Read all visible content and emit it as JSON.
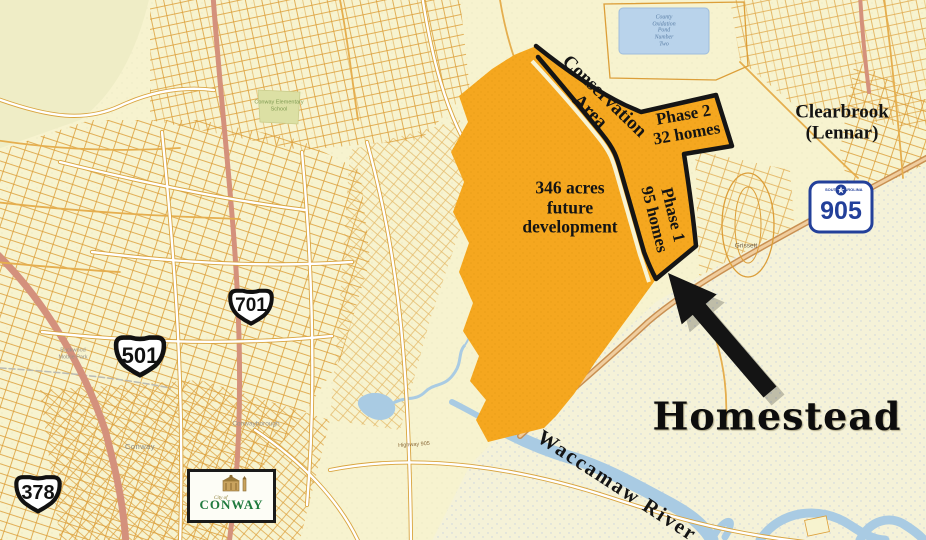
{
  "title": "Homestead development location map",
  "labels": {
    "conservation": [
      "Conservation",
      "Area"
    ],
    "phase2": [
      "Phase 2",
      "32 homes"
    ],
    "phase1": [
      "Phase 1",
      "95 homes"
    ],
    "future": [
      "346 acres",
      "future",
      "development"
    ],
    "clearbrook": [
      "Clearbrook",
      "(Lennar)"
    ],
    "homestead": "Homestead",
    "river": "Waccamaw River"
  },
  "highways": {
    "us701": "701",
    "us501": "501",
    "us378": "378",
    "sc905": "905",
    "sc905_top_left": "SOUTH",
    "sc905_top_right": "CAROLINA"
  },
  "city_logo": {
    "city_of": "City of",
    "name": "CONWAY",
    "subtitle": "SOUTH CAROLINA"
  },
  "place_labels": {
    "conway": "Conway",
    "conwayborough": "Conwayborough",
    "grissett": "Grissett",
    "school": [
      "Conway Elementary",
      "School"
    ],
    "mobile_park": [
      "Buckwood",
      "Mobile Park"
    ],
    "pond": [
      "County",
      "Oxidation",
      "Pond",
      "Number",
      "Two"
    ],
    "highway_905_road": "Highway 905"
  },
  "colors": {
    "development_fill": "#F5A71F",
    "boundary_black": "#151515",
    "map_background": "#F7F3CF",
    "parcel_orange": "#DC9E38",
    "river_blue": "#A9CBE3",
    "shield_blue": "#23409A",
    "logo_green": "#1F7A3D",
    "arrow_black": "#141414"
  }
}
